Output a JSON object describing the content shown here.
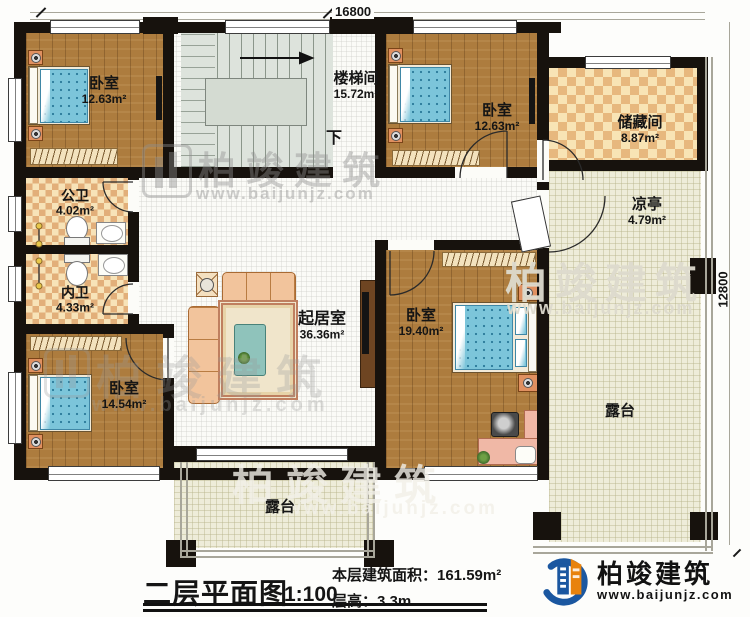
{
  "plan": {
    "dimensions": {
      "top": "16800",
      "right": "12800"
    },
    "stair": {
      "down": "下"
    },
    "rooms": [
      {
        "name": "卧室",
        "area": "12.63m²"
      },
      {
        "name": "楼梯间",
        "area": "15.72m²"
      },
      {
        "name": "卧室",
        "area": "12.63m²"
      },
      {
        "name": "储藏间",
        "area": "8.87m²"
      },
      {
        "name": "凉亭",
        "area": "4.79m²"
      },
      {
        "name": "公卫",
        "area": "4.02m²"
      },
      {
        "name": "内卫",
        "area": "4.33m²"
      },
      {
        "name": "起居室",
        "area": "36.36m²"
      },
      {
        "name": "卧室",
        "area": "19.40m²"
      },
      {
        "name": "卧室",
        "area": "14.54m²"
      },
      {
        "name": "露台",
        "area": ""
      },
      {
        "name": "露台",
        "area": ""
      }
    ]
  },
  "title_block": {
    "title": "二层平面图",
    "scale": "1:100",
    "area_text": "本层建筑面积：161.59m²",
    "height_text": "层高：3.3m"
  },
  "branding": {
    "name": "柏竣建筑",
    "url": "www.baijunjz.com"
  },
  "watermark": {
    "name": "柏竣建筑",
    "url": "www.baijunjz.com"
  },
  "colors": {
    "wall": "#17120d",
    "wood_floor": "#ad7c3e",
    "tile_light": "#f7e3b8",
    "tile_dark": "#e2af7a",
    "stair_floor": "#dde3dc",
    "terrace_floor": "#eeecd9",
    "mattress": "#7cc5da",
    "logo_blue": "#1b57a0",
    "logo_orange": "#e8820c"
  }
}
